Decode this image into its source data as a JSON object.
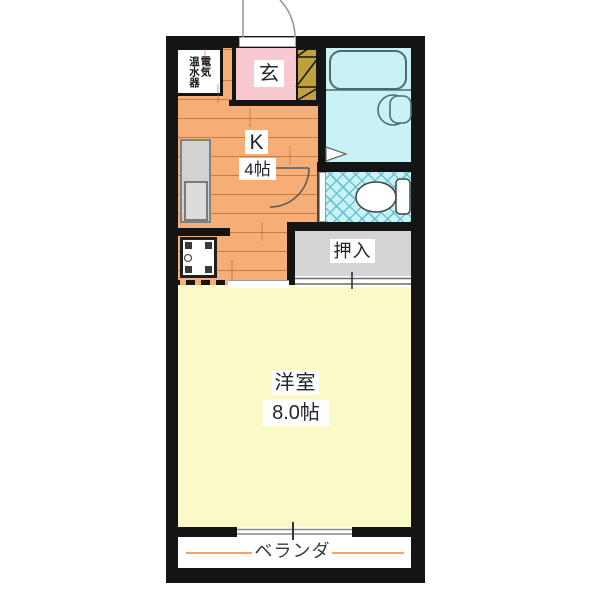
{
  "plan": {
    "type": "apartment-floor-plan",
    "rooms": {
      "entrance": {
        "label": "玄"
      },
      "water_heater": {
        "line1": "電気",
        "line2": "温水器"
      },
      "kitchen": {
        "label": "K",
        "size": "4帖"
      },
      "closet": {
        "label": "押入"
      },
      "western_room": {
        "label": "洋室",
        "size": "8.0帖"
      },
      "veranda": {
        "label": "ベランダ"
      }
    },
    "fixtures": [
      "entry-door-swing",
      "shoe-cabinet-hatch",
      "bathtub",
      "washbasin",
      "bath-door-triangle",
      "kitchen-door-swing",
      "toilet",
      "toilet-door",
      "washing-machine-pan",
      "closet-sliding-door",
      "balcony-sliding-window"
    ],
    "colors": {
      "wall": "#141414",
      "kitchen_floor": "#F5AF76",
      "entrance_floor": "#F9C9D1",
      "bath_floor": "#C9F2F6",
      "closet_floor": "#D4D4D4",
      "western_floor": "#FAFAC8",
      "shoe_cabinet": "#C0A13C",
      "veranda_line": "#EBA668"
    }
  }
}
